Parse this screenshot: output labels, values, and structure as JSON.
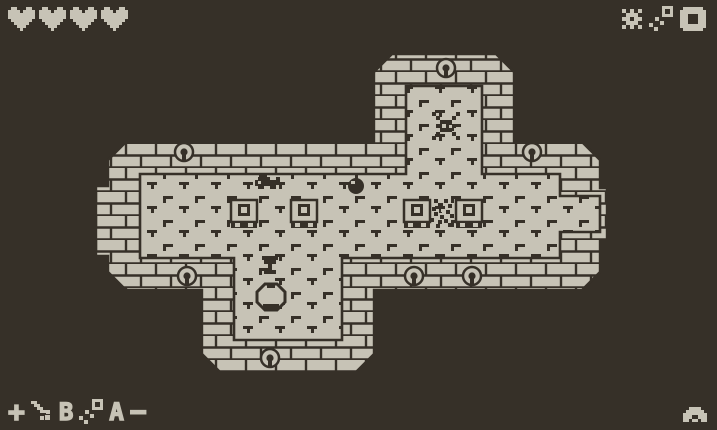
{
  "palette": {
    "background": "#363028",
    "foreground": "#c7c3b6"
  },
  "hud": {
    "hearts": {
      "count": 4,
      "icon": "heart"
    },
    "inventory": {
      "items": [
        {
          "icon": "burst"
        },
        {
          "icon": "sparkle"
        },
        {
          "icon": "empty-slot-box"
        }
      ]
    },
    "controls": {
      "dpad_label": "+",
      "b_item_icon": "sword",
      "b_button_label": "B",
      "a_item_icon": "sparkle",
      "a_button_label": "A",
      "minus_label": "−"
    },
    "menu_icon": "creature"
  },
  "map": {
    "description": "cross-shaped dungeon room with brick walls and tick-marked tile floor",
    "wall_emblems": {
      "icon": "keyhole-emblem",
      "count": 7
    },
    "entities": [
      {
        "icon": "spider-enemy",
        "location": "top corridor"
      },
      {
        "icon": "crawler-enemy",
        "location": "center-left"
      },
      {
        "icon": "ball-enemy",
        "location": "center"
      },
      {
        "icon": "skeleton-enemy",
        "location": "center-right"
      },
      {
        "icon": "pedestal",
        "count": 4
      },
      {
        "icon": "chalice-item",
        "location": "lower corridor"
      },
      {
        "icon": "pot",
        "location": "lower corridor"
      }
    ],
    "doors": [
      "top",
      "right",
      "bottom"
    ]
  }
}
